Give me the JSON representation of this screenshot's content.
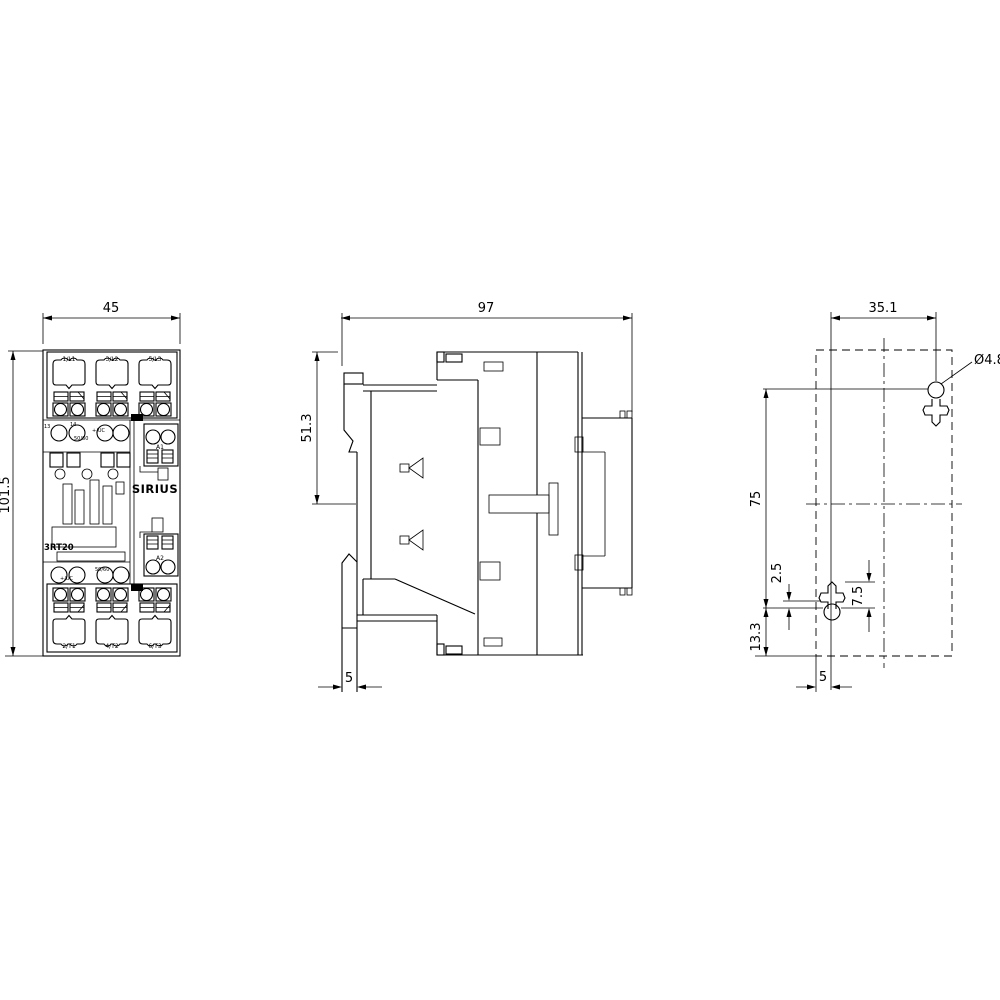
{
  "drawing": {
    "product": {
      "brand": "SIRIUS",
      "model": "3RT20"
    },
    "front_view": {
      "width_dim": "45",
      "height_dim": "101.5",
      "top_terminals": [
        "1/L1",
        "3/L2",
        "5/L3"
      ],
      "bottom_terminals": [
        "2/T1",
        "4/T2",
        "6/T3"
      ],
      "coil_terminal_top": "A1",
      "coil_terminal_bottom": "A2",
      "aux_mark_1": "13",
      "aux_mark_2": "14",
      "coil_mark_top_1": "+/UC",
      "coil_mark_top_2": "50/60",
      "coil_mark_bottom_1": "50/60",
      "coil_mark_bottom_2": "+/UC"
    },
    "side_view": {
      "depth_dim": "97",
      "upper_height_dim": "51.3",
      "rail_foot_dim": "5"
    },
    "drill_view": {
      "hole_spacing_horizontal": "35.1",
      "hole_diameter": "Ø4.8",
      "hole_spacing_vertical": "75",
      "offset_small": "2.5",
      "offset_keyhole": "7.5",
      "offset_bottom": "13.3",
      "edge_offset": "5"
    }
  }
}
